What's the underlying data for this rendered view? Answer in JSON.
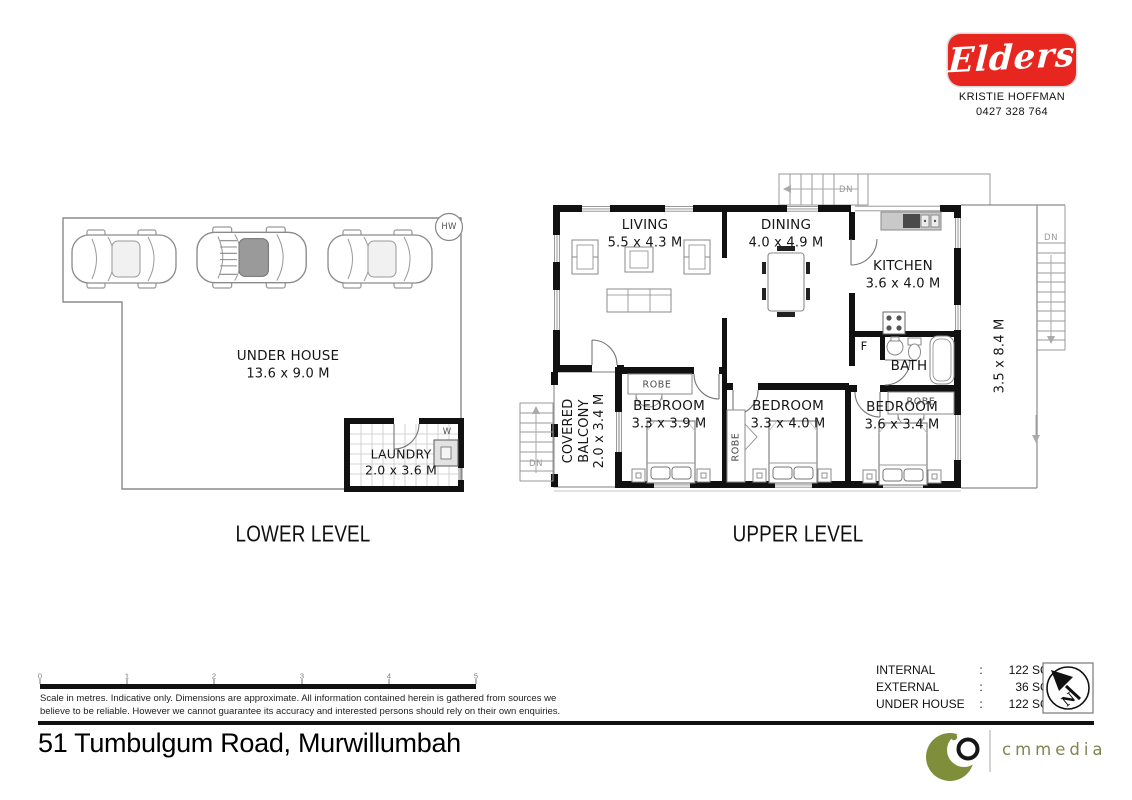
{
  "agent": {
    "brand": "Elders",
    "name": "KRISTIE HOFFMAN",
    "phone": "0427 328 764"
  },
  "address": "51 Tumbulgum Road, Murwillumbah",
  "levels": {
    "lower": "LOWER LEVEL",
    "upper": "UPPER LEVEL"
  },
  "lower": {
    "under_house": {
      "name": "UNDER HOUSE",
      "dims": "13.6 x 9.0 M"
    },
    "laundry": {
      "name": "LAUNDRY",
      "dims": "2.0 x 3.6 M"
    },
    "hot_water": "HW",
    "washer": "W"
  },
  "upper": {
    "living": {
      "name": "LIVING",
      "dims": "5.5 x 4.3 M"
    },
    "dining": {
      "name": "DINING",
      "dims": "4.0 x 4.9 M"
    },
    "kitchen": {
      "name": "KITCHEN",
      "dims": "3.6 x 4.0 M"
    },
    "bath": {
      "name": "BATH"
    },
    "fridge": "F",
    "bed1": {
      "name": "BEDROOM",
      "dims": "3.3 x 3.9 M"
    },
    "bed2": {
      "name": "BEDROOM",
      "dims": "3.3 x 4.0 M"
    },
    "bed3": {
      "name": "BEDROOM",
      "dims": "3.6 x 3.4 M"
    },
    "balcony": {
      "line1": "COVERED",
      "line2": "BALCONY",
      "dims": "2.0 x 3.4 M"
    },
    "deck_dims": "3.5 x 8.4 M",
    "robe": "ROBE",
    "down": "DN"
  },
  "scale": {
    "ticks": [
      "0",
      "1",
      "2",
      "3",
      "4",
      "5"
    ],
    "note1": "Scale in metres.  Indicative only.  Dimensions are approximate.  All information contained herein is gathered from sources we",
    "note2": "believe to be reliable.  However we cannot guarantee its accuracy and interested persons should rely on their own enquiries."
  },
  "areas": {
    "colon": ":",
    "rows": [
      {
        "label": "INTERNAL",
        "value": "122 SQ.M."
      },
      {
        "label": "EXTERNAL",
        "value": "36 SQ.M."
      },
      {
        "label": "UNDER HOUSE",
        "value": "122 SQ.M."
      }
    ]
  },
  "compass": {
    "north": "N"
  },
  "media": {
    "logo_text": "cmmedia"
  },
  "colors": {
    "brand_red": "#E6261F",
    "logo_olive": "#7F8E3B"
  }
}
